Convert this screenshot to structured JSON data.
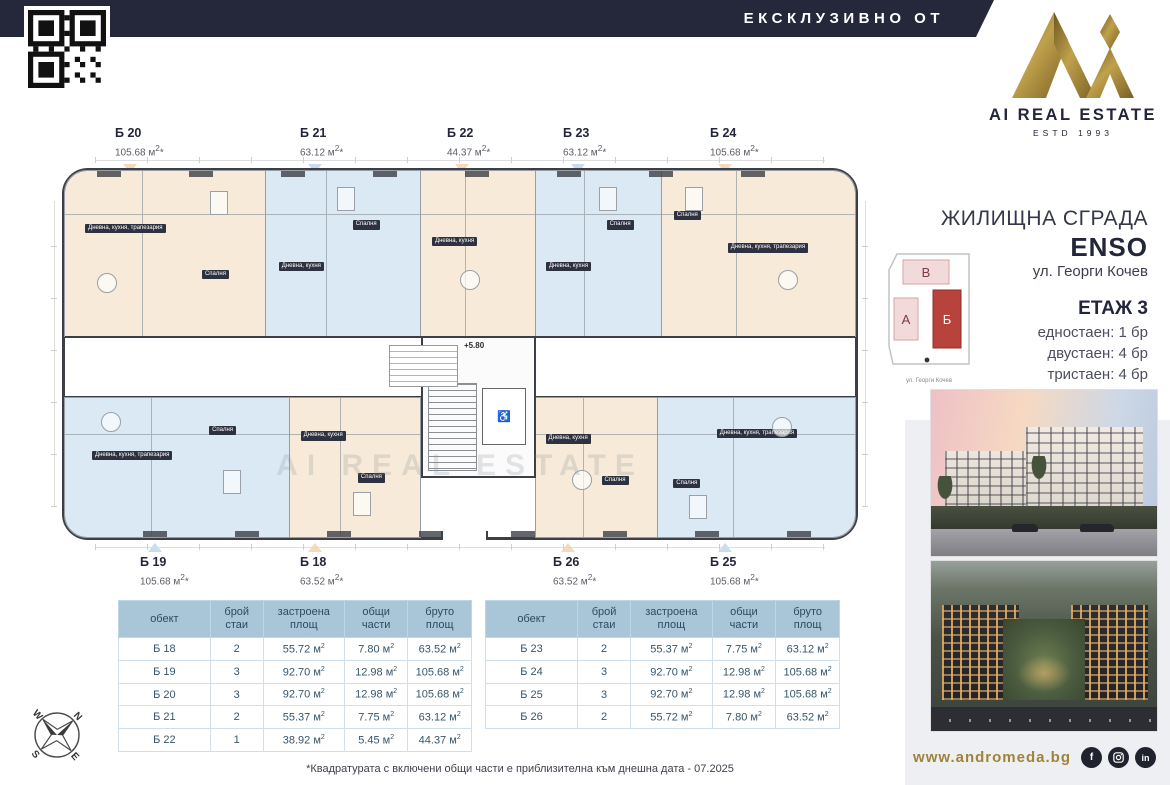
{
  "banner": {
    "label": "ЕКСКЛУЗИВНО ОТ"
  },
  "logo": {
    "title": "AI REAL ESTATE",
    "estd": "ESTD 1993"
  },
  "project": {
    "type_label": "ЖИЛИЩНА СГРАДА",
    "name": "ENSO",
    "address": "ул. Георги Кочев",
    "floor_label": "ЕТАЖ 3",
    "unit_mix": [
      {
        "label": "едностаен: 1 бр"
      },
      {
        "label": "двустаен: 4 бр"
      },
      {
        "label": "тристаен: 4 бр"
      }
    ]
  },
  "sitemap": {
    "block_v": "В",
    "block_a": "А",
    "block_b": "Б",
    "street": "ул. Георги Кочев"
  },
  "plan": {
    "level_mark": "+5.80",
    "watermark": "AI REAL ESTATE",
    "accessibility_icon": "♿",
    "units": {
      "b20": {
        "id": "Б 20",
        "area": "105.68",
        "rooms": [
          "Дневна, кухня, трапезария",
          "Спалня"
        ]
      },
      "b21": {
        "id": "Б 21",
        "area": "63.12",
        "rooms": [
          "Дневна, кухня",
          "Спалня"
        ]
      },
      "b22": {
        "id": "Б 22",
        "area": "44.37",
        "rooms": [
          "Дневна, кухня"
        ]
      },
      "b23": {
        "id": "Б 23",
        "area": "63.12",
        "rooms": [
          "Дневна, кухня",
          "Спалня"
        ]
      },
      "b24": {
        "id": "Б 24",
        "area": "105.68",
        "rooms": [
          "Дневна, кухня, трапезария",
          "Спалня"
        ]
      },
      "b19": {
        "id": "Б 19",
        "area": "105.68",
        "rooms": [
          "Дневна, кухня, трапезария",
          "Спалня"
        ]
      },
      "b18": {
        "id": "Б 18",
        "area": "63.52",
        "rooms": [
          "Дневна, кухня",
          "Спалня"
        ]
      },
      "b26": {
        "id": "Б 26",
        "area": "63.52",
        "rooms": [
          "Дневна, кухня",
          "Спалня"
        ]
      },
      "b25": {
        "id": "Б 25",
        "area": "105.68",
        "rooms": [
          "Дневна, кухня, трапезария",
          "Спалня"
        ]
      }
    }
  },
  "tables": {
    "headers": [
      {
        "l1": "обект",
        "l2": ""
      },
      {
        "l1": "брой",
        "l2": "стаи"
      },
      {
        "l1": "застроена",
        "l2": "площ"
      },
      {
        "l1": "общи части",
        "l2": ""
      },
      {
        "l1": "бруто",
        "l2": "площ"
      }
    ],
    "left_rows": [
      {
        "id": "Б 18",
        "rooms": "2",
        "built": "55.72",
        "common": "7.80",
        "gross": "63.52"
      },
      {
        "id": "Б 19",
        "rooms": "3",
        "built": "92.70",
        "common": "12.98",
        "gross": "105.68"
      },
      {
        "id": "Б 20",
        "rooms": "3",
        "built": "92.70",
        "common": "12.98",
        "gross": "105.68"
      },
      {
        "id": "Б 21",
        "rooms": "2",
        "built": "55.37",
        "common": "7.75",
        "gross": "63.12"
      },
      {
        "id": "Б 22",
        "rooms": "1",
        "built": "38.92",
        "common": "5.45",
        "gross": "44.37"
      }
    ],
    "right_rows": [
      {
        "id": "Б 23",
        "rooms": "2",
        "built": "55.37",
        "common": "7.75",
        "gross": "63.12"
      },
      {
        "id": "Б 24",
        "rooms": "3",
        "built": "92.70",
        "common": "12.98",
        "gross": "105.68"
      },
      {
        "id": "Б 25",
        "rooms": "3",
        "built": "92.70",
        "common": "12.98",
        "gross": "105.68"
      },
      {
        "id": "Б 26",
        "rooms": "2",
        "built": "55.72",
        "common": "7.80",
        "gross": "63.52"
      }
    ]
  },
  "footer": {
    "disclaimer": "*Квадратурата с включени общи части е приблизителна към днешна дата - 07.2025",
    "website": "www.andromeda.bg"
  },
  "compass": {
    "n": "N",
    "e": "E",
    "s": "S",
    "w": "W"
  },
  "colors": {
    "navy": "#25273a",
    "gold": "#9c7c35",
    "cream": "#f7ead9",
    "blue": "#dbe9f4",
    "table_header": "#a9c5d8",
    "red_block": "#b8423c",
    "pink_block": "#f2d9da"
  }
}
